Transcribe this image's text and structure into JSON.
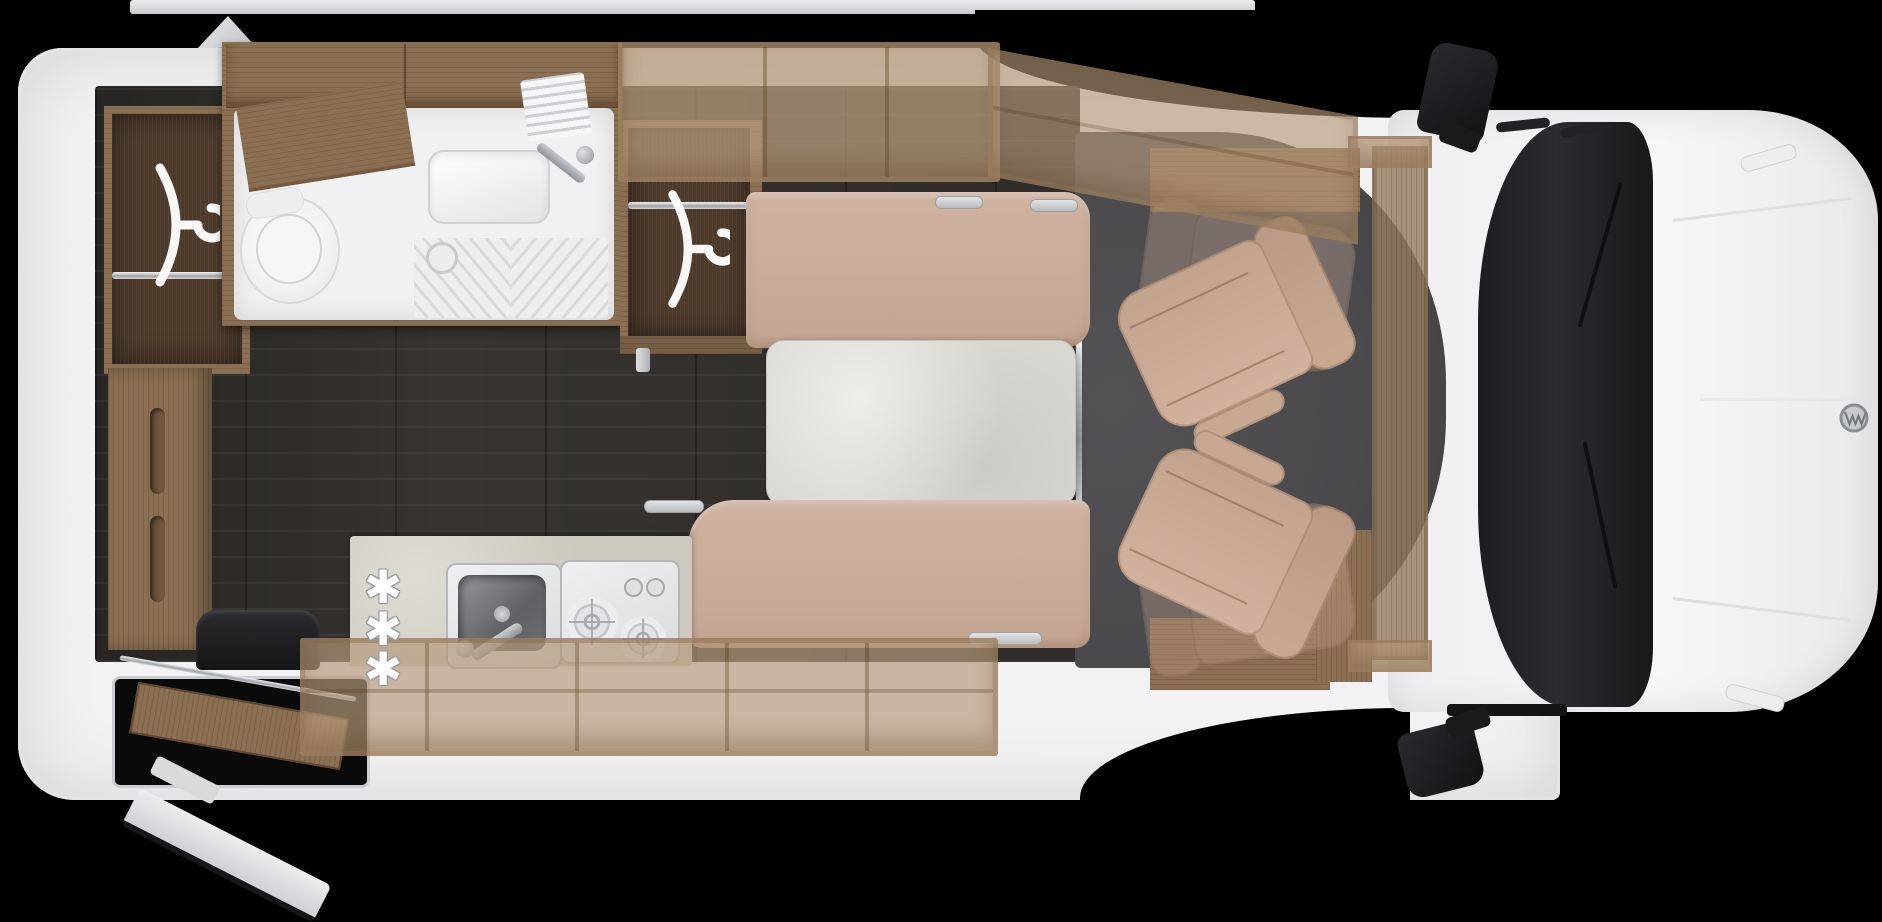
{
  "scene": {
    "title": "Camper van floor plan - top view",
    "vehicle_badge_icon": "vw-logo"
  },
  "colors": {
    "c-bg": "#000000",
    "c-body": "#f2f2f4",
    "c-wall": "#e8e8ea",
    "c-floor": "#363330",
    "c-cabfloor": "#4a4a4d",
    "c-wooddark": "#4c3a2b",
    "c-woodmid": "#8b6f52",
    "c-beige1": "#cfb3a0",
    "c-beige2": "#c3a692",
    "c-table": "#d9d7d1",
    "c-counter": "#cdc9be",
    "c-steel": "#e9eaec",
    "c-windshield": "#202124",
    "c-black": "#17171a"
  },
  "exterior": {
    "awning": "awning-rail",
    "roof_vent": "roof-vent",
    "mirrors": [
      "driver-side-mirror",
      "passenger-side-mirror"
    ],
    "windshield": "windshield",
    "entry_step": "entry-step-well",
    "open_door": "open-door-leaf"
  },
  "rooms": {
    "bathroom": {
      "fixtures": [
        "shower-tray",
        "toilet",
        "washbasin",
        "faucet",
        "drain-grooves",
        "vent-grille",
        "wood-shelf"
      ]
    },
    "wardrobes": [
      {
        "id": "rear-wardrobe",
        "icon": "clothes-hanger-icon",
        "rail": "chrome-rail"
      },
      {
        "id": "mid-wardrobe",
        "icon": "clothes-hanger-icon",
        "rail": "chrome-rail"
      }
    ],
    "kitchen": {
      "appliances": [
        "sink",
        "two-burner-hob"
      ],
      "option_markers": [
        "✱",
        "✱",
        "✱"
      ]
    },
    "dinette": {
      "furniture": [
        "top-bench",
        "table",
        "bottom-bench"
      ]
    },
    "cab": {
      "seats": [
        "driver-swivel-seat",
        "passenger-swivel-seat"
      ],
      "ghost_seats": [
        "driver-seat-forward-position",
        "passenger-seat-forward-position"
      ]
    },
    "storage": [
      "overhead-cabinet-top",
      "overhead-cabinet-overcab",
      "overhead-cabinet-bottom",
      "rear-lower-cabinet",
      "seat-pedestal",
      "drop-down-bed-panel"
    ]
  }
}
